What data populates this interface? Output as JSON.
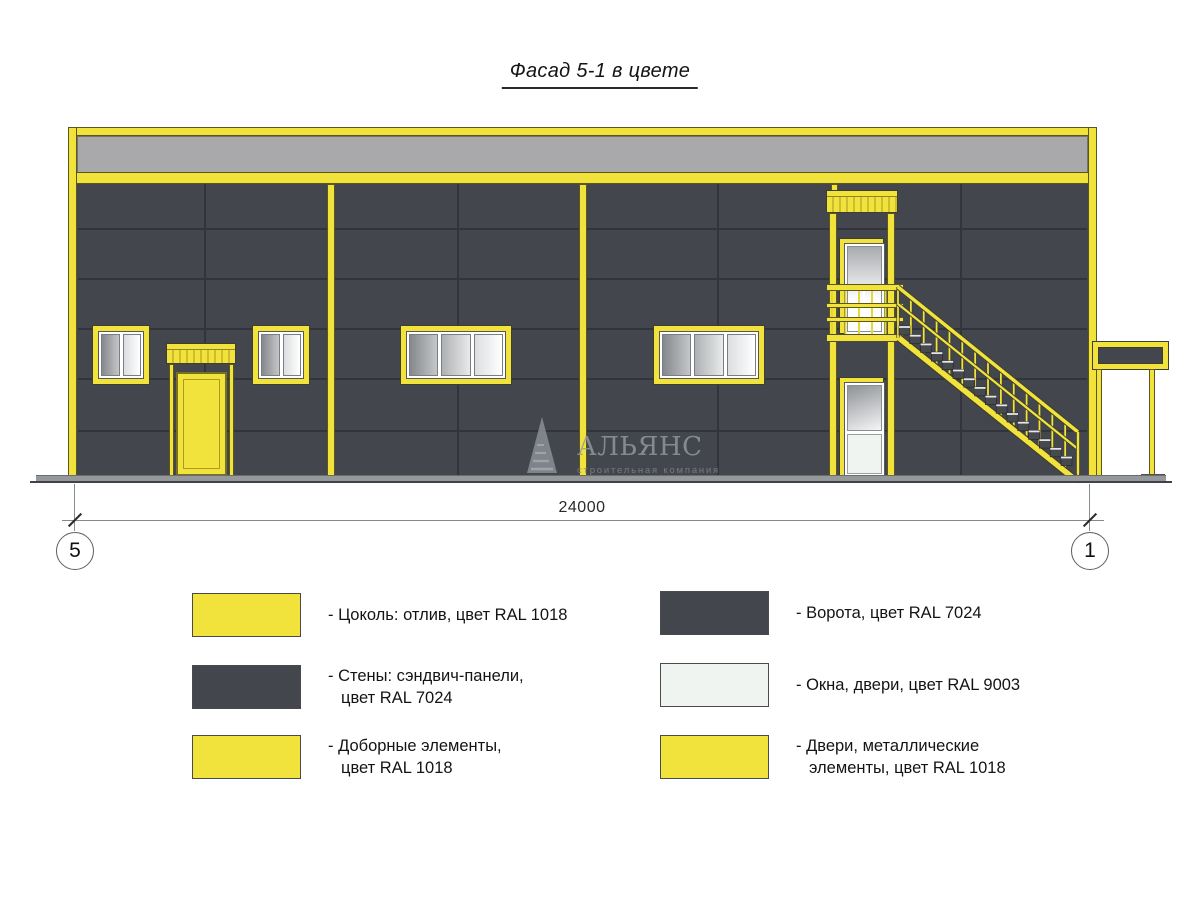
{
  "title": "Фасад 5-1 в цвете",
  "dimension": {
    "value": "24000"
  },
  "axes": {
    "left": "5",
    "right": "1"
  },
  "watermark": {
    "name": "АЛЬЯНС",
    "subtitle": "строительная компания"
  },
  "colors": {
    "ral_1018": "#f2e23c",
    "ral_7024": "#43464d",
    "ral_9003": "#eff4f0",
    "parapet_gray": "#a9a9ab"
  },
  "legend": {
    "left": [
      {
        "swatch": "#f2e23c",
        "lines": [
          "- Цоколь: отлив, цвет RAL 1018"
        ]
      },
      {
        "swatch": "#43464d",
        "lines": [
          "- Стены: сэндвич-панели,",
          "цвет RAL 7024"
        ]
      },
      {
        "swatch": "#f2e23c",
        "lines": [
          "- Доборные элементы,",
          "цвет RAL 1018"
        ]
      }
    ],
    "right": [
      {
        "swatch": "#43464d",
        "lines": [
          "- Ворота, цвет RAL 7024"
        ]
      },
      {
        "swatch": "#eff4f0",
        "lines": [
          "- Окна, двери, цвет RAL 9003"
        ]
      },
      {
        "swatch": "#f2e23c",
        "lines": [
          "- Двери, металлические",
          "элементы, цвет RAL 1018"
        ]
      }
    ]
  }
}
